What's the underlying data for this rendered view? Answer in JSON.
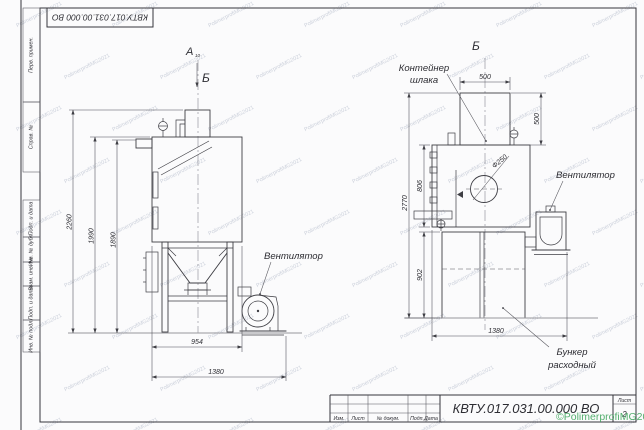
{
  "page": {
    "watermark_tile": "PolimerprofiMG2021",
    "watermark_green": "©PolimerprofiMG2021",
    "line_color": "#3e3e44",
    "accent_green": "#3ea55c"
  },
  "frame": {
    "top_stamp": "КВТУ.017.031.00.000  ВО",
    "margin_cells": [
      "Перв. примен.",
      "Справ. №",
      "Подп. и дата",
      "Инв. № дубл.",
      "Взам. инв. №",
      "Подп. и дата",
      "Инв. № подл."
    ]
  },
  "title_block": {
    "designation": "КВТУ.017.031.00.000  ВО",
    "row_labels": [
      "Изм.",
      "Лист",
      "№ докум.",
      "Подп.",
      "Дата"
    ],
    "sheet_label": "Лист",
    "sheet_number": "2"
  },
  "views": {
    "view_a": {
      "label": "А",
      "sub": "10",
      "arrow_label": "Б"
    },
    "view_b": {
      "title": "Б"
    }
  },
  "annotations": {
    "fan_left": "Вентилятор",
    "fan_right": "Вентилятор",
    "slag_container_line1": "Контейнер",
    "slag_container_line2": "шлака",
    "hopper_line1": "Бункер",
    "hopper_line2": "расходный",
    "diameter": "Ф250"
  },
  "dimensions": {
    "left_view": {
      "height_total": "2260",
      "height_body": "1990",
      "height_flange": "1890",
      "width_stand": "954",
      "width_total": "1380"
    },
    "right_view": {
      "container_width": "500",
      "container_height": "500",
      "cabinet_height": "806",
      "total_height": "2770",
      "stand_height": "902",
      "stand_width": "1380"
    }
  }
}
